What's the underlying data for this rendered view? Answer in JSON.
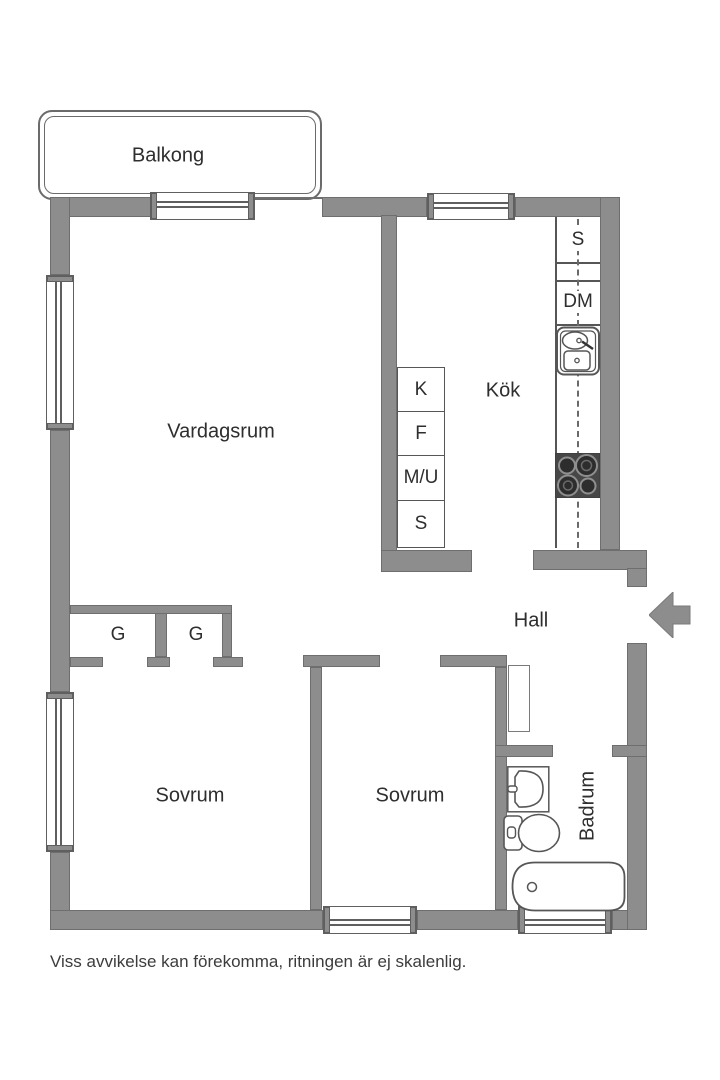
{
  "plan": {
    "caption": "Viss avvikelse kan förekomma, ritningen är ej skalenlig.",
    "rooms": {
      "balcony": "Balkong",
      "living_room": "Vardagsrum",
      "kitchen": "Kök",
      "hall": "Hall",
      "bedroom1": "Sovrum",
      "bedroom2": "Sovrum",
      "bathroom": "Badrum",
      "closet1": "G",
      "closet2": "G"
    },
    "kitchen_units": {
      "left_column": [
        "K",
        "F",
        "M/U",
        "S"
      ],
      "right_column": [
        "S",
        "DM"
      ]
    },
    "icons": {
      "entrance_arrow": "arrow-pointing-left-into-entrance"
    },
    "colors": {
      "wall": "#8d8d8d",
      "wall_outline": "#6e6e6e",
      "fixture_line": "#565656",
      "stove_top": "#474747",
      "text": "#2e2e2e",
      "background": "#ffffff"
    }
  }
}
